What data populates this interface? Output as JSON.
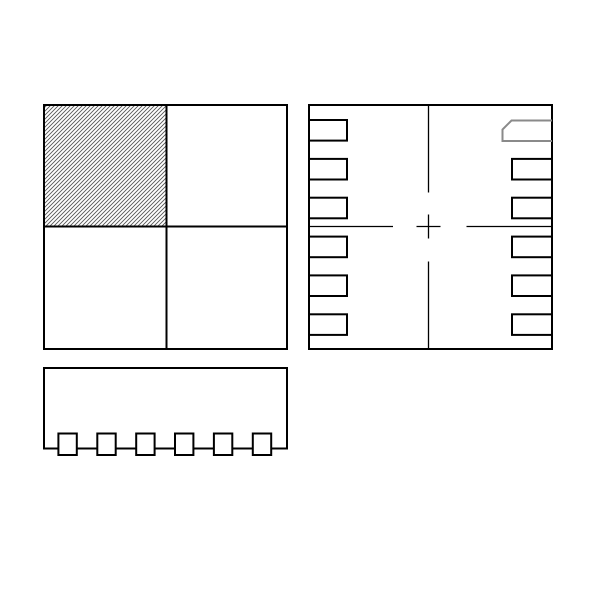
{
  "page": {
    "width": 600,
    "height": 600,
    "background": "#ffffff"
  },
  "drawing": {
    "kind": "ic-package-outline-drawing",
    "colors": {
      "line": "#000000",
      "pin1_marker": "#8a8a8a",
      "hatch": "#555555",
      "fill": "#ffffff"
    },
    "strokes": {
      "outline": 2,
      "pad": 2,
      "centerline": 1.3,
      "hatch_line": 0.9,
      "hatch_spacing": 4
    },
    "top_view": {
      "name": "package-top-view",
      "rect": {
        "x": 44,
        "y": 105,
        "w": 243,
        "h": 244
      },
      "divider_x": 166.5,
      "divider_y": 226.5,
      "hatched_quadrant": {
        "position": "top-left",
        "x": 44,
        "y": 105,
        "w": 122.5,
        "h": 121.5
      }
    },
    "bottom_view": {
      "name": "package-bottom-view",
      "rect": {
        "x": 309,
        "y": 105,
        "w": 243,
        "h": 244
      },
      "pad_h": 20.6,
      "pad_tops": [
        120,
        158.9,
        197.7,
        236.6,
        275.4,
        314.3
      ],
      "left_pads": {
        "count": 6,
        "x": 309,
        "w": 38
      },
      "right_pads": {
        "count": 5,
        "x": 512,
        "w": 40,
        "top_indices": [
          1,
          2,
          3,
          4,
          5
        ]
      },
      "pin1_pad": {
        "name": "pin1-indicator-pad",
        "points": [
          [
            552,
            120.5
          ],
          [
            511.5,
            120.5
          ],
          [
            502.5,
            129.5
          ],
          [
            502.5,
            141
          ],
          [
            552,
            141
          ]
        ]
      },
      "centerlines": {
        "h_y": 226.5,
        "h_segments": [
          [
            309,
            393
          ],
          [
            416.5,
            440.5
          ],
          [
            466.5,
            552
          ]
        ],
        "v_x": 428.5,
        "v_segments": [
          [
            105,
            192.5
          ],
          [
            214.5,
            238.5
          ],
          [
            261.5,
            349
          ]
        ]
      }
    },
    "side_view": {
      "name": "package-side-view",
      "rect": {
        "x": 44,
        "y": 368,
        "w": 243,
        "h": 80.5
      },
      "lead": {
        "w": 18.4,
        "h": 21.5,
        "y": 433.5
      },
      "lead_lefts": [
        58.4,
        97.3,
        136.2,
        175.0,
        213.9,
        252.8
      ]
    }
  }
}
